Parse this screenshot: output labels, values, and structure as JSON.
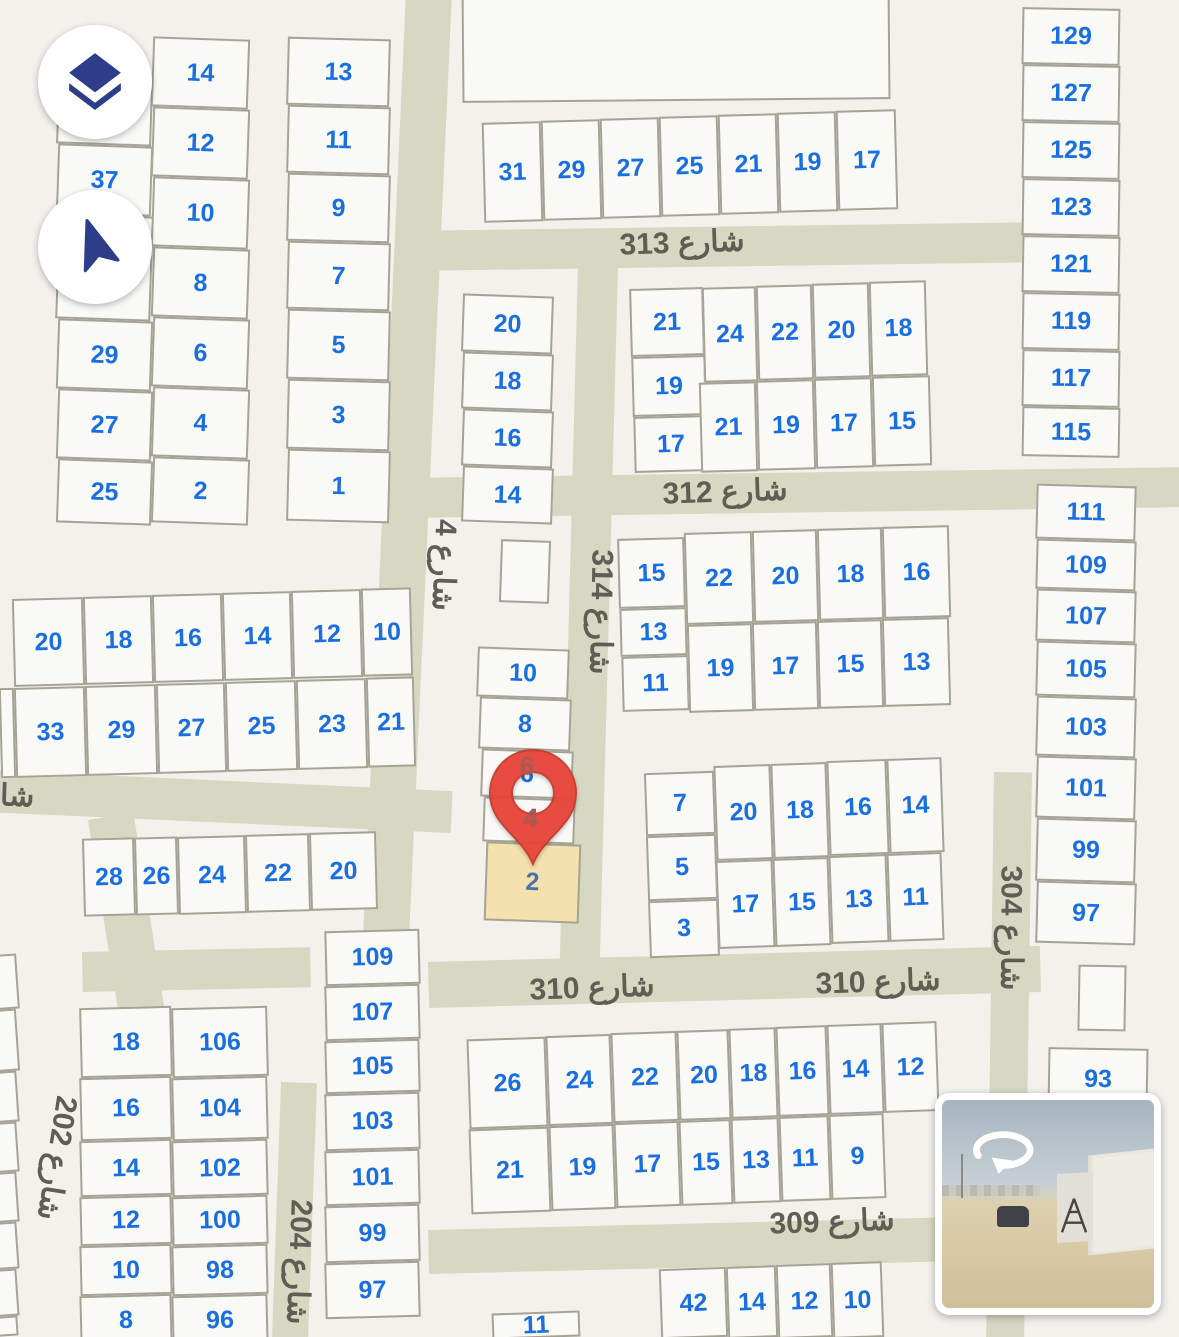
{
  "controls": {
    "layers_button": {
      "icon": "layers-icon"
    },
    "compass_button": {
      "icon": "navigation-arrow-icon"
    }
  },
  "pin": {
    "selected_plot": "2"
  },
  "streetview_thumbnail": {
    "icon": "street-view-rotate-icon"
  },
  "colors": {
    "plot_number": "#1a6fe0",
    "street_label": "#5e5e55",
    "road": "#d6d8c2",
    "plot_fill": "#f9f9f6",
    "plot_border": "#a5a296",
    "highlight_fill": "#f3e1ae",
    "pin_red": "#e8463a",
    "icon_navy": "#2e3d8a"
  },
  "street_labels": [
    {
      "t": "شارع 313",
      "x": 682,
      "y": 243,
      "r": -2
    },
    {
      "t": "شارع 312",
      "x": 725,
      "y": 492,
      "r": -2
    },
    {
      "t": "شارع 310",
      "x": 592,
      "y": 988,
      "r": -2
    },
    {
      "t": "شارع 310",
      "x": 878,
      "y": 982,
      "r": -2
    },
    {
      "t": "شارع 309",
      "x": 832,
      "y": 1222,
      "r": -2
    },
    {
      "t": "شارع 4",
      "x": 444,
      "y": 565,
      "r": 92
    },
    {
      "t": "شارع 314",
      "x": 601,
      "y": 612,
      "r": 91
    },
    {
      "t": "شارع 304",
      "x": 1011,
      "y": 928,
      "r": 90
    },
    {
      "t": "شارع 202",
      "x": 57,
      "y": 1158,
      "r": 99
    },
    {
      "t": "شارع 204",
      "x": 299,
      "y": 1262,
      "r": 92
    },
    {
      "t": "شار",
      "x": 10,
      "y": 796,
      "r": 2
    }
  ],
  "ghost_numbers": [
    {
      "t": "6",
      "x": 527,
      "y": 766
    },
    {
      "t": "4",
      "x": 531,
      "y": 818
    }
  ],
  "plots": [
    {
      "t": "14",
      "x": 152,
      "y": 38,
      "w": 97,
      "h": 70,
      "r": 2
    },
    {
      "t": "12",
      "x": 152,
      "y": 108,
      "w": 97,
      "h": 70,
      "r": 2
    },
    {
      "t": "10",
      "x": 152,
      "y": 178,
      "w": 97,
      "h": 70,
      "r": 2
    },
    {
      "t": "8",
      "x": 152,
      "y": 248,
      "w": 97,
      "h": 70,
      "r": 2
    },
    {
      "t": "6",
      "x": 152,
      "y": 318,
      "w": 97,
      "h": 70,
      "r": 2
    },
    {
      "t": "4",
      "x": 152,
      "y": 388,
      "w": 97,
      "h": 70,
      "r": 2
    },
    {
      "t": "2",
      "x": 152,
      "y": 458,
      "w": 97,
      "h": 66,
      "r": 2
    },
    {
      "t": "",
      "x": 57,
      "y": 88,
      "w": 95,
      "h": 57,
      "r": 2
    },
    {
      "t": "37",
      "x": 57,
      "y": 145,
      "w": 95,
      "h": 70,
      "r": 2
    },
    {
      "t": "",
      "x": 57,
      "y": 215,
      "w": 95,
      "h": 105,
      "r": 2
    },
    {
      "t": "29",
      "x": 57,
      "y": 320,
      "w": 95,
      "h": 70,
      "r": 2
    },
    {
      "t": "27",
      "x": 57,
      "y": 390,
      "w": 95,
      "h": 70,
      "r": 2
    },
    {
      "t": "25",
      "x": 57,
      "y": 460,
      "w": 95,
      "h": 64,
      "r": 2
    },
    {
      "t": "13",
      "x": 287,
      "y": 38,
      "w": 103,
      "h": 68,
      "r": 1.5
    },
    {
      "t": "11",
      "x": 287,
      "y": 106,
      "w": 103,
      "h": 68,
      "r": 1.5
    },
    {
      "t": "9",
      "x": 287,
      "y": 174,
      "w": 103,
      "h": 68,
      "r": 1.5
    },
    {
      "t": "7",
      "x": 287,
      "y": 242,
      "w": 103,
      "h": 68,
      "r": 1.5
    },
    {
      "t": "5",
      "x": 287,
      "y": 310,
      "w": 103,
      "h": 70,
      "r": 1.5
    },
    {
      "t": "3",
      "x": 287,
      "y": 380,
      "w": 103,
      "h": 70,
      "r": 1.5
    },
    {
      "t": "1",
      "x": 287,
      "y": 450,
      "w": 103,
      "h": 72,
      "r": 1.5
    },
    {
      "t": "",
      "x": 462,
      "y": -15,
      "w": 428,
      "h": 116,
      "r": -0.5
    },
    {
      "t": "31",
      "x": 483,
      "y": 122,
      "w": 59,
      "h": 100,
      "r": -1.5
    },
    {
      "t": "29",
      "x": 542,
      "y": 120,
      "w": 59,
      "h": 100,
      "r": -1.5
    },
    {
      "t": "27",
      "x": 601,
      "y": 118,
      "w": 59,
      "h": 100,
      "r": -1.5
    },
    {
      "t": "25",
      "x": 660,
      "y": 116,
      "w": 59,
      "h": 100,
      "r": -1.5
    },
    {
      "t": "21",
      "x": 719,
      "y": 114,
      "w": 59,
      "h": 100,
      "r": -1.5
    },
    {
      "t": "19",
      "x": 778,
      "y": 112,
      "w": 59,
      "h": 100,
      "r": -1.5
    },
    {
      "t": "17",
      "x": 837,
      "y": 110,
      "w": 60,
      "h": 100,
      "r": -1.5
    },
    {
      "t": "129",
      "x": 1022,
      "y": 8,
      "w": 98,
      "h": 57,
      "r": 1
    },
    {
      "t": "127",
      "x": 1022,
      "y": 65,
      "w": 98,
      "h": 57,
      "r": 1
    },
    {
      "t": "125",
      "x": 1022,
      "y": 122,
      "w": 98,
      "h": 57,
      "r": 1
    },
    {
      "t": "123",
      "x": 1022,
      "y": 179,
      "w": 98,
      "h": 57,
      "r": 1
    },
    {
      "t": "121",
      "x": 1022,
      "y": 236,
      "w": 98,
      "h": 57,
      "r": 1
    },
    {
      "t": "119",
      "x": 1022,
      "y": 293,
      "w": 98,
      "h": 57,
      "r": 1
    },
    {
      "t": "117",
      "x": 1022,
      "y": 350,
      "w": 98,
      "h": 57,
      "r": 1
    },
    {
      "t": "115",
      "x": 1022,
      "y": 407,
      "w": 98,
      "h": 50,
      "r": 1
    },
    {
      "t": "111",
      "x": 1036,
      "y": 485,
      "w": 100,
      "h": 55,
      "r": 1.6
    },
    {
      "t": "109",
      "x": 1036,
      "y": 540,
      "w": 100,
      "h": 50,
      "r": 1.6
    },
    {
      "t": "107",
      "x": 1036,
      "y": 590,
      "w": 100,
      "h": 52,
      "r": 1.6
    },
    {
      "t": "105",
      "x": 1036,
      "y": 642,
      "w": 100,
      "h": 55,
      "r": 1.6
    },
    {
      "t": "103",
      "x": 1036,
      "y": 697,
      "w": 100,
      "h": 60,
      "r": 1.6
    },
    {
      "t": "101",
      "x": 1036,
      "y": 757,
      "w": 100,
      "h": 62,
      "r": 1.6
    },
    {
      "t": "99",
      "x": 1036,
      "y": 819,
      "w": 100,
      "h": 63,
      "r": 1.6
    },
    {
      "t": "97",
      "x": 1036,
      "y": 882,
      "w": 100,
      "h": 62,
      "r": 1.6
    },
    {
      "t": "20",
      "x": 462,
      "y": 295,
      "w": 91,
      "h": 58,
      "r": 2
    },
    {
      "t": "18",
      "x": 462,
      "y": 353,
      "w": 91,
      "h": 57,
      "r": 2
    },
    {
      "t": "16",
      "x": 462,
      "y": 410,
      "w": 91,
      "h": 57,
      "r": 2
    },
    {
      "t": "14",
      "x": 462,
      "y": 467,
      "w": 91,
      "h": 56,
      "r": 2
    },
    {
      "t": "",
      "x": 500,
      "y": 540,
      "w": 50,
      "h": 63,
      "r": 2
    },
    {
      "t": "10",
      "x": 477,
      "y": 648,
      "w": 92,
      "h": 50,
      "r": 2
    },
    {
      "t": "8",
      "x": 479,
      "y": 698,
      "w": 92,
      "h": 52,
      "r": 2
    },
    {
      "t": "6",
      "x": 481,
      "y": 750,
      "w": 92,
      "h": 48,
      "r": 2
    },
    {
      "t": "4",
      "x": 483,
      "y": 798,
      "w": 92,
      "h": 45,
      "r": 2
    },
    {
      "t": "2",
      "x": 485,
      "y": 843,
      "w": 95,
      "h": 79,
      "r": 2,
      "c": "hl"
    },
    {
      "t": "21",
      "x": 630,
      "y": 288,
      "w": 74,
      "h": 68,
      "r": -1.5
    },
    {
      "t": "19",
      "x": 632,
      "y": 356,
      "w": 74,
      "h": 60,
      "r": -1.5
    },
    {
      "t": "17",
      "x": 634,
      "y": 416,
      "w": 74,
      "h": 56,
      "r": -1.5
    },
    {
      "t": "24",
      "x": 703,
      "y": 287,
      "w": 54,
      "h": 95,
      "r": -1.5
    },
    {
      "t": "22",
      "x": 757,
      "y": 285,
      "w": 56,
      "h": 95,
      "r": -1.5
    },
    {
      "t": "20",
      "x": 813,
      "y": 283,
      "w": 57,
      "h": 95,
      "r": -1.5
    },
    {
      "t": "18",
      "x": 870,
      "y": 281,
      "w": 57,
      "h": 95,
      "r": -1.5
    },
    {
      "t": "21",
      "x": 700,
      "y": 382,
      "w": 57,
      "h": 90,
      "r": -1.5
    },
    {
      "t": "19",
      "x": 757,
      "y": 380,
      "w": 58,
      "h": 90,
      "r": -1.5
    },
    {
      "t": "17",
      "x": 815,
      "y": 378,
      "w": 58,
      "h": 90,
      "r": -1.5
    },
    {
      "t": "15",
      "x": 873,
      "y": 376,
      "w": 58,
      "h": 90,
      "r": -1.5
    },
    {
      "t": "15",
      "x": 618,
      "y": 538,
      "w": 67,
      "h": 70,
      "r": -1.5
    },
    {
      "t": "13",
      "x": 620,
      "y": 608,
      "w": 67,
      "h": 48,
      "r": -1.5
    },
    {
      "t": "11",
      "x": 622,
      "y": 656,
      "w": 67,
      "h": 55,
      "r": -1.5
    },
    {
      "t": "22",
      "x": 685,
      "y": 532,
      "w": 68,
      "h": 92,
      "r": -1.5
    },
    {
      "t": "20",
      "x": 753,
      "y": 530,
      "w": 65,
      "h": 92,
      "r": -1.5
    },
    {
      "t": "18",
      "x": 818,
      "y": 528,
      "w": 65,
      "h": 92,
      "r": -1.5
    },
    {
      "t": "16",
      "x": 883,
      "y": 526,
      "w": 67,
      "h": 92,
      "r": -1.5
    },
    {
      "t": "19",
      "x": 688,
      "y": 624,
      "w": 65,
      "h": 88,
      "r": -1.5
    },
    {
      "t": "17",
      "x": 753,
      "y": 622,
      "w": 65,
      "h": 88,
      "r": -1.5
    },
    {
      "t": "15",
      "x": 818,
      "y": 620,
      "w": 65,
      "h": 88,
      "r": -1.5
    },
    {
      "t": "13",
      "x": 883,
      "y": 618,
      "w": 67,
      "h": 88,
      "r": -1.5
    },
    {
      "t": "7",
      "x": 645,
      "y": 772,
      "w": 70,
      "h": 63,
      "r": -2
    },
    {
      "t": "5",
      "x": 647,
      "y": 835,
      "w": 70,
      "h": 65,
      "r": -2
    },
    {
      "t": "3",
      "x": 649,
      "y": 900,
      "w": 70,
      "h": 57,
      "r": -2
    },
    {
      "t": "20",
      "x": 715,
      "y": 765,
      "w": 57,
      "h": 95,
      "r": -2
    },
    {
      "t": "18",
      "x": 772,
      "y": 763,
      "w": 56,
      "h": 95,
      "r": -2
    },
    {
      "t": "16",
      "x": 828,
      "y": 760,
      "w": 60,
      "h": 95,
      "r": -2
    },
    {
      "t": "14",
      "x": 888,
      "y": 758,
      "w": 55,
      "h": 95,
      "r": -2
    },
    {
      "t": "17",
      "x": 717,
      "y": 860,
      "w": 57,
      "h": 88,
      "r": -2
    },
    {
      "t": "15",
      "x": 774,
      "y": 858,
      "w": 56,
      "h": 88,
      "r": -2
    },
    {
      "t": "13",
      "x": 830,
      "y": 855,
      "w": 58,
      "h": 88,
      "r": -2
    },
    {
      "t": "11",
      "x": 888,
      "y": 853,
      "w": 55,
      "h": 88,
      "r": -2
    },
    {
      "t": "20",
      "x": 13,
      "y": 598,
      "w": 71,
      "h": 88,
      "r": -1.5
    },
    {
      "t": "18",
      "x": 84,
      "y": 596,
      "w": 69,
      "h": 88,
      "r": -1.5
    },
    {
      "t": "16",
      "x": 153,
      "y": 594,
      "w": 70,
      "h": 88,
      "r": -1.5
    },
    {
      "t": "14",
      "x": 223,
      "y": 592,
      "w": 69,
      "h": 88,
      "r": -1.5
    },
    {
      "t": "12",
      "x": 292,
      "y": 590,
      "w": 70,
      "h": 88,
      "r": -1.5
    },
    {
      "t": "10",
      "x": 362,
      "y": 588,
      "w": 50,
      "h": 88,
      "r": -1.5
    },
    {
      "t": "",
      "x": 0,
      "y": 688,
      "w": 15,
      "h": 90,
      "r": -1.5
    },
    {
      "t": "33",
      "x": 15,
      "y": 687,
      "w": 71,
      "h": 90,
      "r": -1.5
    },
    {
      "t": "29",
      "x": 86,
      "y": 685,
      "w": 71,
      "h": 90,
      "r": -1.5
    },
    {
      "t": "27",
      "x": 157,
      "y": 683,
      "w": 69,
      "h": 90,
      "r": -1.5
    },
    {
      "t": "25",
      "x": 226,
      "y": 681,
      "w": 71,
      "h": 90,
      "r": -1.5
    },
    {
      "t": "23",
      "x": 297,
      "y": 679,
      "w": 70,
      "h": 90,
      "r": -1.5
    },
    {
      "t": "21",
      "x": 367,
      "y": 677,
      "w": 48,
      "h": 90,
      "r": -1.5
    },
    {
      "t": "28",
      "x": 83,
      "y": 838,
      "w": 52,
      "h": 78,
      "r": -1.5
    },
    {
      "t": "26",
      "x": 135,
      "y": 837,
      "w": 43,
      "h": 78,
      "r": -1.5
    },
    {
      "t": "24",
      "x": 178,
      "y": 836,
      "w": 68,
      "h": 78,
      "r": -1.5
    },
    {
      "t": "22",
      "x": 246,
      "y": 834,
      "w": 64,
      "h": 78,
      "r": -1.5
    },
    {
      "t": "20",
      "x": 310,
      "y": 832,
      "w": 67,
      "h": 78,
      "r": -1.5
    },
    {
      "t": "",
      "x": -28,
      "y": 955,
      "w": 46,
      "h": 55,
      "r": -4
    },
    {
      "t": "",
      "x": -28,
      "y": 1010,
      "w": 46,
      "h": 62,
      "r": -4
    },
    {
      "t": "",
      "x": -28,
      "y": 1072,
      "w": 46,
      "h": 51,
      "r": -4
    },
    {
      "t": "",
      "x": -28,
      "y": 1123,
      "w": 46,
      "h": 50,
      "r": -4
    },
    {
      "t": "",
      "x": -28,
      "y": 1173,
      "w": 46,
      "h": 50,
      "r": -4
    },
    {
      "t": "",
      "x": -28,
      "y": 1223,
      "w": 46,
      "h": 47,
      "r": -4
    },
    {
      "t": "",
      "x": -28,
      "y": 1270,
      "w": 46,
      "h": 47,
      "r": -4
    },
    {
      "t": "",
      "x": -28,
      "y": 1317,
      "w": 46,
      "h": 20,
      "r": -4
    },
    {
      "t": "18",
      "x": 80,
      "y": 1007,
      "w": 92,
      "h": 70,
      "r": -1.5
    },
    {
      "t": "16",
      "x": 80,
      "y": 1077,
      "w": 92,
      "h": 63,
      "r": -1.5
    },
    {
      "t": "14",
      "x": 80,
      "y": 1140,
      "w": 92,
      "h": 56,
      "r": -1.5
    },
    {
      "t": "12",
      "x": 80,
      "y": 1196,
      "w": 92,
      "h": 49,
      "r": -1.5
    },
    {
      "t": "10",
      "x": 80,
      "y": 1245,
      "w": 92,
      "h": 50,
      "r": -1.5
    },
    {
      "t": "8",
      "x": 80,
      "y": 1295,
      "w": 92,
      "h": 50,
      "r": -1.5
    },
    {
      "t": "106",
      "x": 172,
      "y": 1007,
      "w": 96,
      "h": 70,
      "r": -1.5
    },
    {
      "t": "104",
      "x": 172,
      "y": 1077,
      "w": 96,
      "h": 63,
      "r": -1.5
    },
    {
      "t": "102",
      "x": 172,
      "y": 1140,
      "w": 96,
      "h": 56,
      "r": -1.5
    },
    {
      "t": "100",
      "x": 172,
      "y": 1196,
      "w": 96,
      "h": 49,
      "r": -1.5
    },
    {
      "t": "98",
      "x": 172,
      "y": 1245,
      "w": 96,
      "h": 50,
      "r": -1.5
    },
    {
      "t": "96",
      "x": 172,
      "y": 1295,
      "w": 96,
      "h": 50,
      "r": -1.5
    },
    {
      "t": "109",
      "x": 325,
      "y": 930,
      "w": 95,
      "h": 55,
      "r": -1.5
    },
    {
      "t": "107",
      "x": 325,
      "y": 985,
      "w": 95,
      "h": 55,
      "r": -1.5
    },
    {
      "t": "105",
      "x": 325,
      "y": 1040,
      "w": 95,
      "h": 53,
      "r": -1.5
    },
    {
      "t": "103",
      "x": 325,
      "y": 1093,
      "w": 95,
      "h": 57,
      "r": -1.5
    },
    {
      "t": "101",
      "x": 325,
      "y": 1150,
      "w": 95,
      "h": 55,
      "r": -1.5
    },
    {
      "t": "99",
      "x": 325,
      "y": 1205,
      "w": 95,
      "h": 57,
      "r": -1.5
    },
    {
      "t": "97",
      "x": 325,
      "y": 1262,
      "w": 95,
      "h": 56,
      "r": -1.5
    },
    {
      "t": "26",
      "x": 468,
      "y": 1038,
      "w": 79,
      "h": 90,
      "r": -2
    },
    {
      "t": "24",
      "x": 547,
      "y": 1035,
      "w": 65,
      "h": 90,
      "r": -2
    },
    {
      "t": "22",
      "x": 612,
      "y": 1032,
      "w": 66,
      "h": 90,
      "r": -2
    },
    {
      "t": "20",
      "x": 678,
      "y": 1030,
      "w": 52,
      "h": 90,
      "r": -2
    },
    {
      "t": "18",
      "x": 730,
      "y": 1028,
      "w": 47,
      "h": 90,
      "r": -2
    },
    {
      "t": "16",
      "x": 777,
      "y": 1026,
      "w": 51,
      "h": 90,
      "r": -2
    },
    {
      "t": "14",
      "x": 828,
      "y": 1024,
      "w": 55,
      "h": 90,
      "r": -2
    },
    {
      "t": "12",
      "x": 883,
      "y": 1022,
      "w": 55,
      "h": 90,
      "r": -2
    },
    {
      "t": "21",
      "x": 470,
      "y": 1128,
      "w": 80,
      "h": 85,
      "r": -2
    },
    {
      "t": "19",
      "x": 550,
      "y": 1125,
      "w": 65,
      "h": 85,
      "r": -2
    },
    {
      "t": "17",
      "x": 615,
      "y": 1122,
      "w": 65,
      "h": 85,
      "r": -2
    },
    {
      "t": "15",
      "x": 680,
      "y": 1120,
      "w": 52,
      "h": 85,
      "r": -2
    },
    {
      "t": "13",
      "x": 732,
      "y": 1118,
      "w": 48,
      "h": 85,
      "r": -2
    },
    {
      "t": "11",
      "x": 780,
      "y": 1116,
      "w": 50,
      "h": 85,
      "r": -2
    },
    {
      "t": "9",
      "x": 830,
      "y": 1114,
      "w": 55,
      "h": 85,
      "r": -2
    },
    {
      "t": "42",
      "x": 660,
      "y": 1268,
      "w": 67,
      "h": 70,
      "r": -2
    },
    {
      "t": "14",
      "x": 727,
      "y": 1266,
      "w": 50,
      "h": 72,
      "r": -2
    },
    {
      "t": "12",
      "x": 777,
      "y": 1264,
      "w": 55,
      "h": 74,
      "r": -2
    },
    {
      "t": "10",
      "x": 832,
      "y": 1262,
      "w": 51,
      "h": 76,
      "r": -2
    },
    {
      "t": "11",
      "x": 492,
      "y": 1312,
      "w": 88,
      "h": 26,
      "r": -2
    },
    {
      "t": "93",
      "x": 1048,
      "y": 1048,
      "w": 100,
      "h": 62,
      "r": 1
    },
    {
      "t": "",
      "x": 1078,
      "y": 965,
      "w": 48,
      "h": 66,
      "r": 1
    }
  ]
}
